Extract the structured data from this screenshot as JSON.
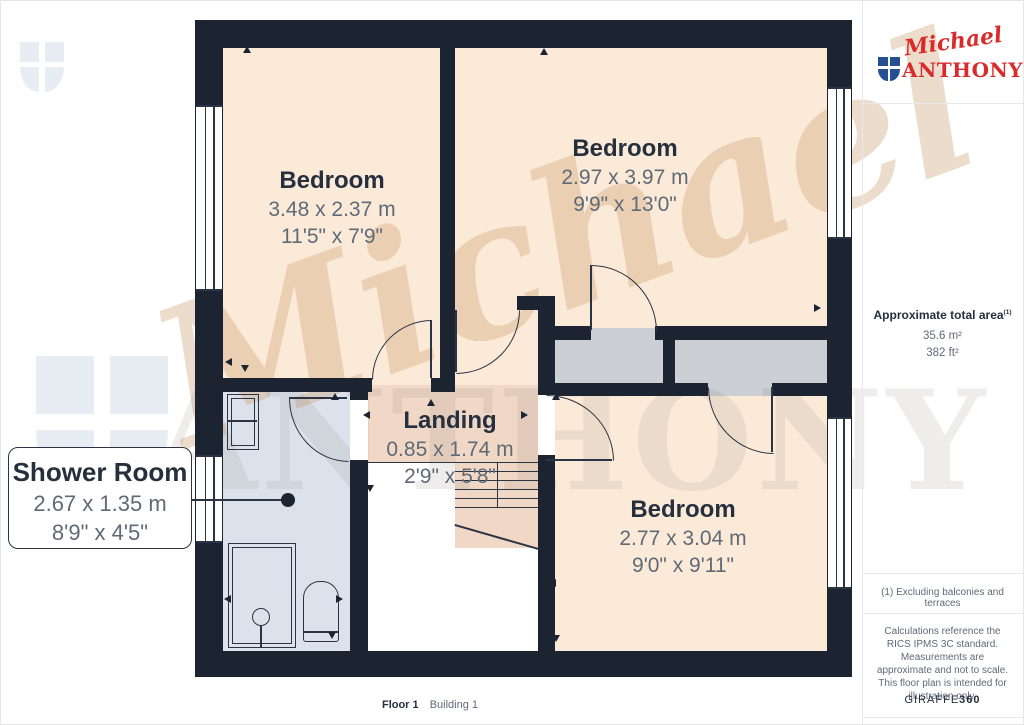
{
  "brand": {
    "script": "Michael",
    "name": "ANTHONY"
  },
  "watermark": {
    "script": "Michael",
    "name": "ANTHONY"
  },
  "rooms": {
    "bedroom_top_left": {
      "name": "Bedroom",
      "metric": "3.48 x 2.37 m",
      "imperial": "11'5\" x 7'9\""
    },
    "bedroom_top_right": {
      "name": "Bedroom",
      "metric": "2.97 x 3.97 m",
      "imperial": "9'9\" x 13'0\""
    },
    "bedroom_bottom_right": {
      "name": "Bedroom",
      "metric": "2.77 x 3.04 m",
      "imperial": "9'0\" x 9'11\""
    },
    "landing": {
      "name": "Landing",
      "metric": "0.85 x 1.74 m",
      "imperial": "2'9\" x 5'8\""
    },
    "shower_room": {
      "name": "Shower Room",
      "metric": "2.67 x 1.35 m",
      "imperial": "8'9\" x 4'5\""
    }
  },
  "sidebar": {
    "area_title": "Approximate total area",
    "area_sup": "(1)",
    "area_metric": "35.6 m²",
    "area_imperial": "382 ft²",
    "footnote": "(1) Excluding balconies and terraces",
    "disclaimer": "Calculations reference the RICS IPMS 3C standard. Measurements are approximate and not to scale. This floor plan is intended for illustration only.",
    "brand_name": "GIRAFFE",
    "brand_suffix": "360"
  },
  "floor_label": {
    "floor": "Floor 1",
    "building": "Building 1"
  },
  "colors": {
    "wall": "#1c2431",
    "line": "#2b3444",
    "room": "#fcead8",
    "landing": "#f1d8c6",
    "shower": "#dce2ec",
    "storage": "#cbcfd3",
    "text_dark": "#252f3e",
    "text_gray": "#5f6a77",
    "brand_red": "#d92b2b",
    "brand_blue": "#26508f",
    "wm_gray": "#e8ecf3",
    "wm_warm": "rgba(206,162,117,0.38)",
    "wm_neutral": "rgba(134,125,120,0.14)"
  }
}
